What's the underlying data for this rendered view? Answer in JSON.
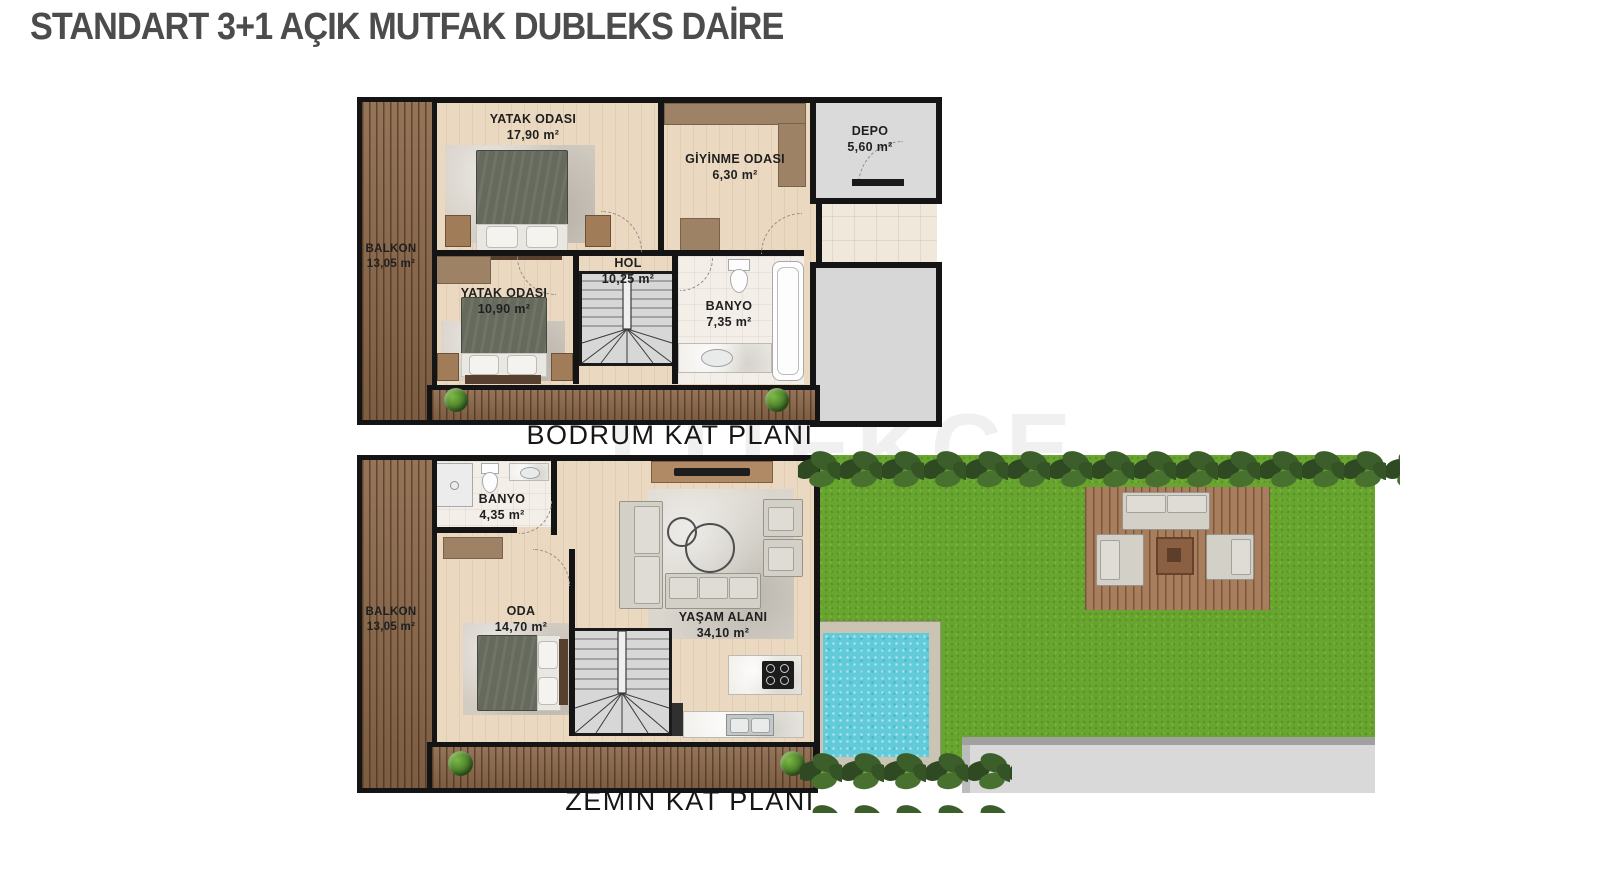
{
  "title": "STANDART 3+1 AÇIK MUTFAK DUBLEKS DAİRE",
  "watermark": "TEKCE",
  "floors": [
    {
      "label": "BODRUM KAT PLANI",
      "rooms": {
        "bedroom1": {
          "name": "YATAK ODASI",
          "area": "17,90 m²"
        },
        "dressing": {
          "name": "GİYİNME ODASI",
          "area": "6,30 m²"
        },
        "depo": {
          "name": "DEPO",
          "area": "5,60 m²"
        },
        "balcony": {
          "name": "BALKON",
          "area": "13,05 m²"
        },
        "bedroom2": {
          "name": "YATAK ODASI",
          "area": "10,90 m²"
        },
        "hall": {
          "name": "HOL",
          "area": "10,25 m²"
        },
        "bath": {
          "name": "BANYO",
          "area": "7,35 m²"
        }
      }
    },
    {
      "label": "ZEMİN KAT PLANI",
      "rooms": {
        "bath": {
          "name": "BANYO",
          "area": "4,35 m²"
        },
        "room": {
          "name": "ODA",
          "area": "14,70 m²"
        },
        "balcony": {
          "name": "BALKON",
          "area": "13,05 m²"
        },
        "living": {
          "name": "YAŞAM ALANI",
          "area": "34,10 m²"
        }
      }
    }
  ],
  "colors": {
    "wall": "#141414",
    "wood_deck": "#8d6a4c",
    "interior_floor": "#ead9c0",
    "grass": "#67a52f",
    "pool_water": "#62cbd9",
    "title_text": "#4c4c4c"
  }
}
